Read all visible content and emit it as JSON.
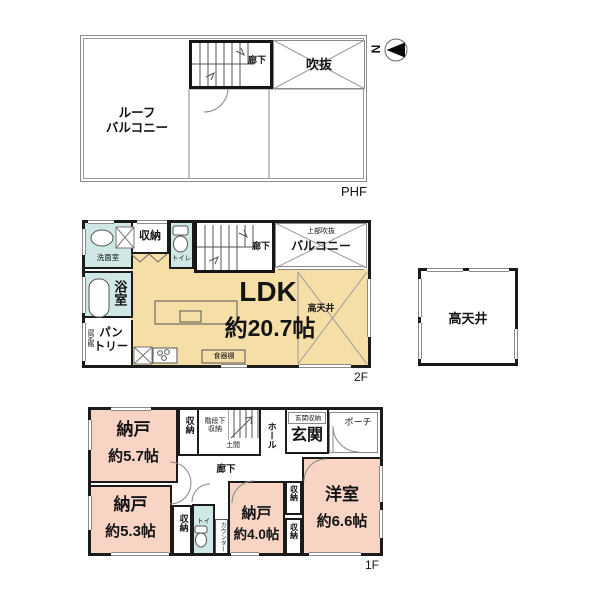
{
  "colors": {
    "room_pink": "#f8d4c4",
    "room_beige": "#f5dfa6",
    "room_blue": "#cfe8e6",
    "wall_black": "#1b1b1b",
    "thin_line_gray": "#8a8a8a"
  },
  "compass": {
    "north": "N"
  },
  "phf": {
    "label": "PHF",
    "roof_balcony": "ルーフ\nバルコニー",
    "corridor": "廊下",
    "void": "吹抜"
  },
  "f2": {
    "label": "2F",
    "washroom": "洗面室",
    "closet": "収納",
    "toilet": "トイレ",
    "corridor": "廊下",
    "upper_void": "上部吹抜",
    "balcony": "バルコニー",
    "ldk": "LDK",
    "ldk_size": "約20.7帖",
    "high_ceiling": "高天井",
    "bath": "浴室",
    "pantry": "パン\nトリー",
    "fixed_shelf": "固定棚",
    "cupboard": "食器棚"
  },
  "annex": {
    "high_ceiling": "高天井"
  },
  "f1": {
    "label": "1F",
    "storage57": "納戸",
    "storage57_size": "約5.7帖",
    "closet_top": "収納",
    "under_stair_storage": "階段下\n収納",
    "doma": "土間",
    "hall": "ホール",
    "entrance_storage": "玄関収納",
    "entrance": "玄関",
    "porch": "ポーチ",
    "corridor": "廊下",
    "storage53": "納戸",
    "storage53_size": "約5.3帖",
    "closet_mid": "収納",
    "toilet": "トイレ",
    "counter": "カウンター",
    "storage40": "納戸",
    "storage40_size": "約4.0帖",
    "closet_right_top": "収納",
    "closet_right_bottom": "収納",
    "western": "洋室",
    "western_size": "約6.6帖"
  }
}
